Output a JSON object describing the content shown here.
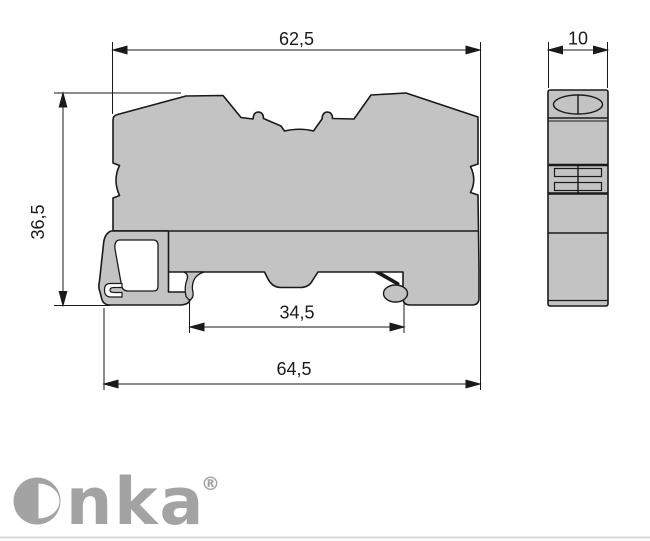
{
  "drawing": {
    "dimensions": {
      "top_width": "62,5",
      "height": "36,5",
      "rail_recess_width": "34,5",
      "overall_width": "64,5",
      "block_thickness": "10"
    },
    "colors": {
      "part_fill": "#c3c3c3",
      "outline": "#1a1a1a",
      "dim_line": "#1a1a1a",
      "logo_gray": "#a3a3a3",
      "footer_rule": "#d9d9d9"
    }
  },
  "logo": {
    "brand": "Onka",
    "wordmark_tail": "nka",
    "registered_mark": "®"
  }
}
